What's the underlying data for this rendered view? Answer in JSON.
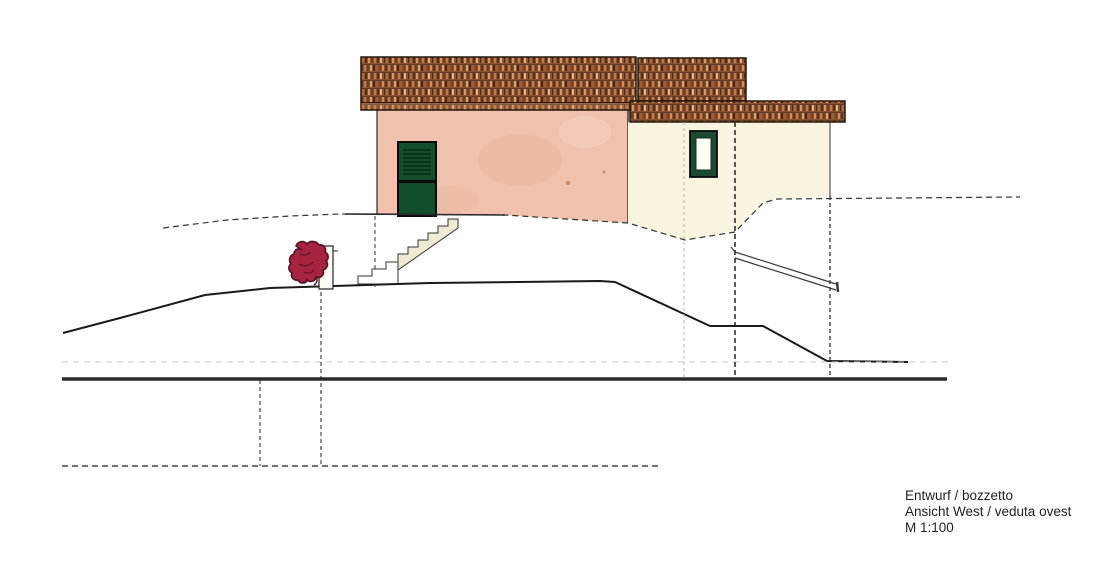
{
  "title_block": {
    "line1": "Entwurf / bozzetto",
    "line2": "Ansicht West / veduta ovest",
    "line3": "M 1:100"
  },
  "drawing": {
    "type": "architectural elevation sketch",
    "view": "west elevation of a house on sloping terrain with tiled roofs, entry door, stairs and shrub"
  },
  "colors": {
    "background": "#ffffff",
    "roof_base": "#8a5434",
    "roof_dark": "#3a2214",
    "wall_pink": "#f0c2ad",
    "wall_cream": "#f8f4e0",
    "door_green": "#124e2c",
    "window_frame_green": "#1c4a30",
    "window_pane": "#fcfcf4",
    "step_fill": "#f0ead2",
    "bush_red": "#a62440",
    "line_black": "#1a1a1a",
    "line_gray": "#c8c8c4"
  }
}
